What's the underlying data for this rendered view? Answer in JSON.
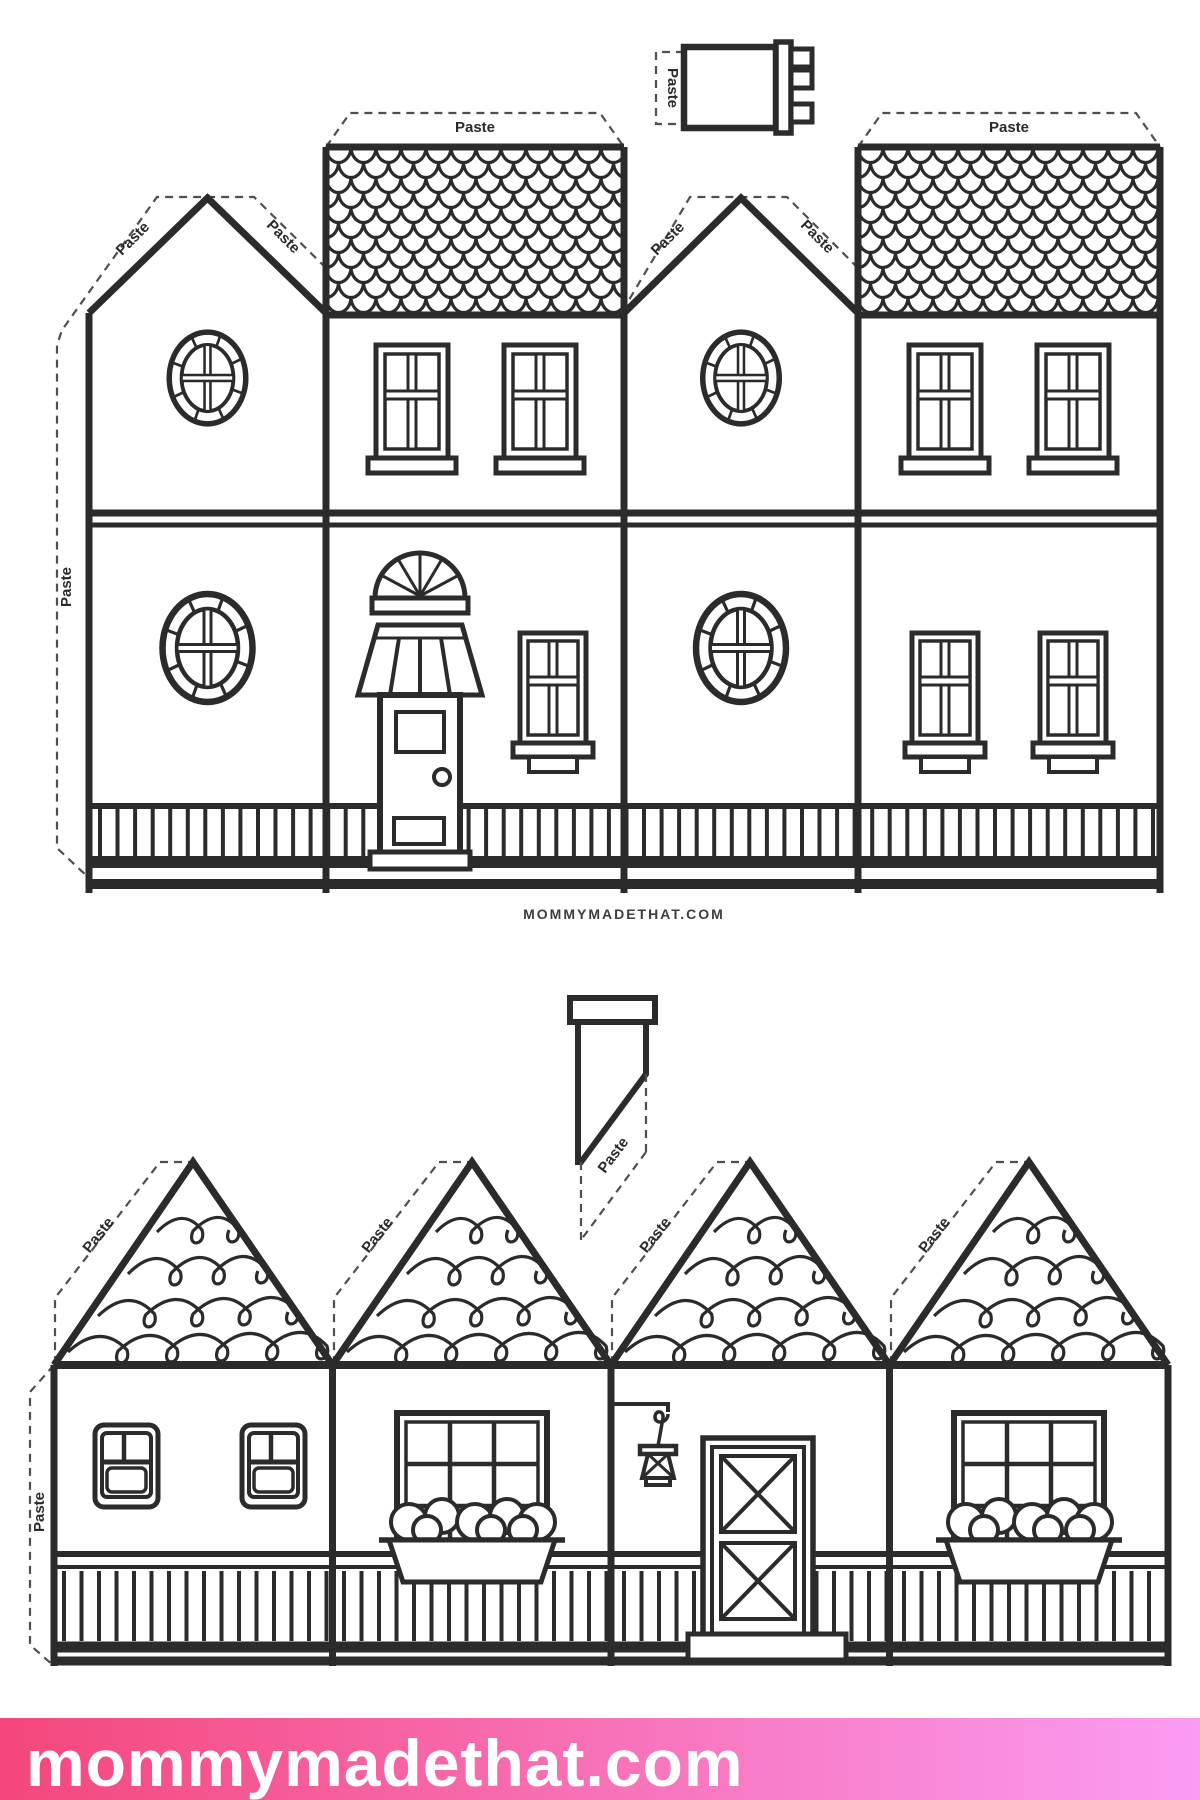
{
  "page": {
    "background": "#ffffff",
    "width": 1200,
    "height": 1800
  },
  "labels": {
    "paste": "Paste"
  },
  "branding": {
    "watermark": "MOMMYMADETHAT.COM",
    "banner_text": "mommymadethat.com"
  },
  "colors": {
    "line": "#2b2b2b",
    "dash": "#4f4f4f",
    "banner_left": "#f4477b",
    "banner_right": "#fa9cf3",
    "banner_text_color": "#ffffff",
    "watermark_color": "#3d3d3d"
  },
  "templates": [
    {
      "id": "two-story-townhouse-strip",
      "paste_tabs_on_strip": 7,
      "chimney_pieces": 1,
      "sections": [
        "gable end with two round windows",
        "fish-scale shingle facade with fanlight door, awning and windows",
        "gable end with two round windows",
        "fish-scale shingle facade with four windows"
      ]
    },
    {
      "id": "garland-cottage-strip",
      "paste_tabs_on_strip": 5,
      "chimney_pieces": 1,
      "sections": [
        "cottage with two small windows",
        "cottage with flower-box window",
        "cottage with barn door and lantern",
        "cottage with flower-box window"
      ]
    }
  ]
}
